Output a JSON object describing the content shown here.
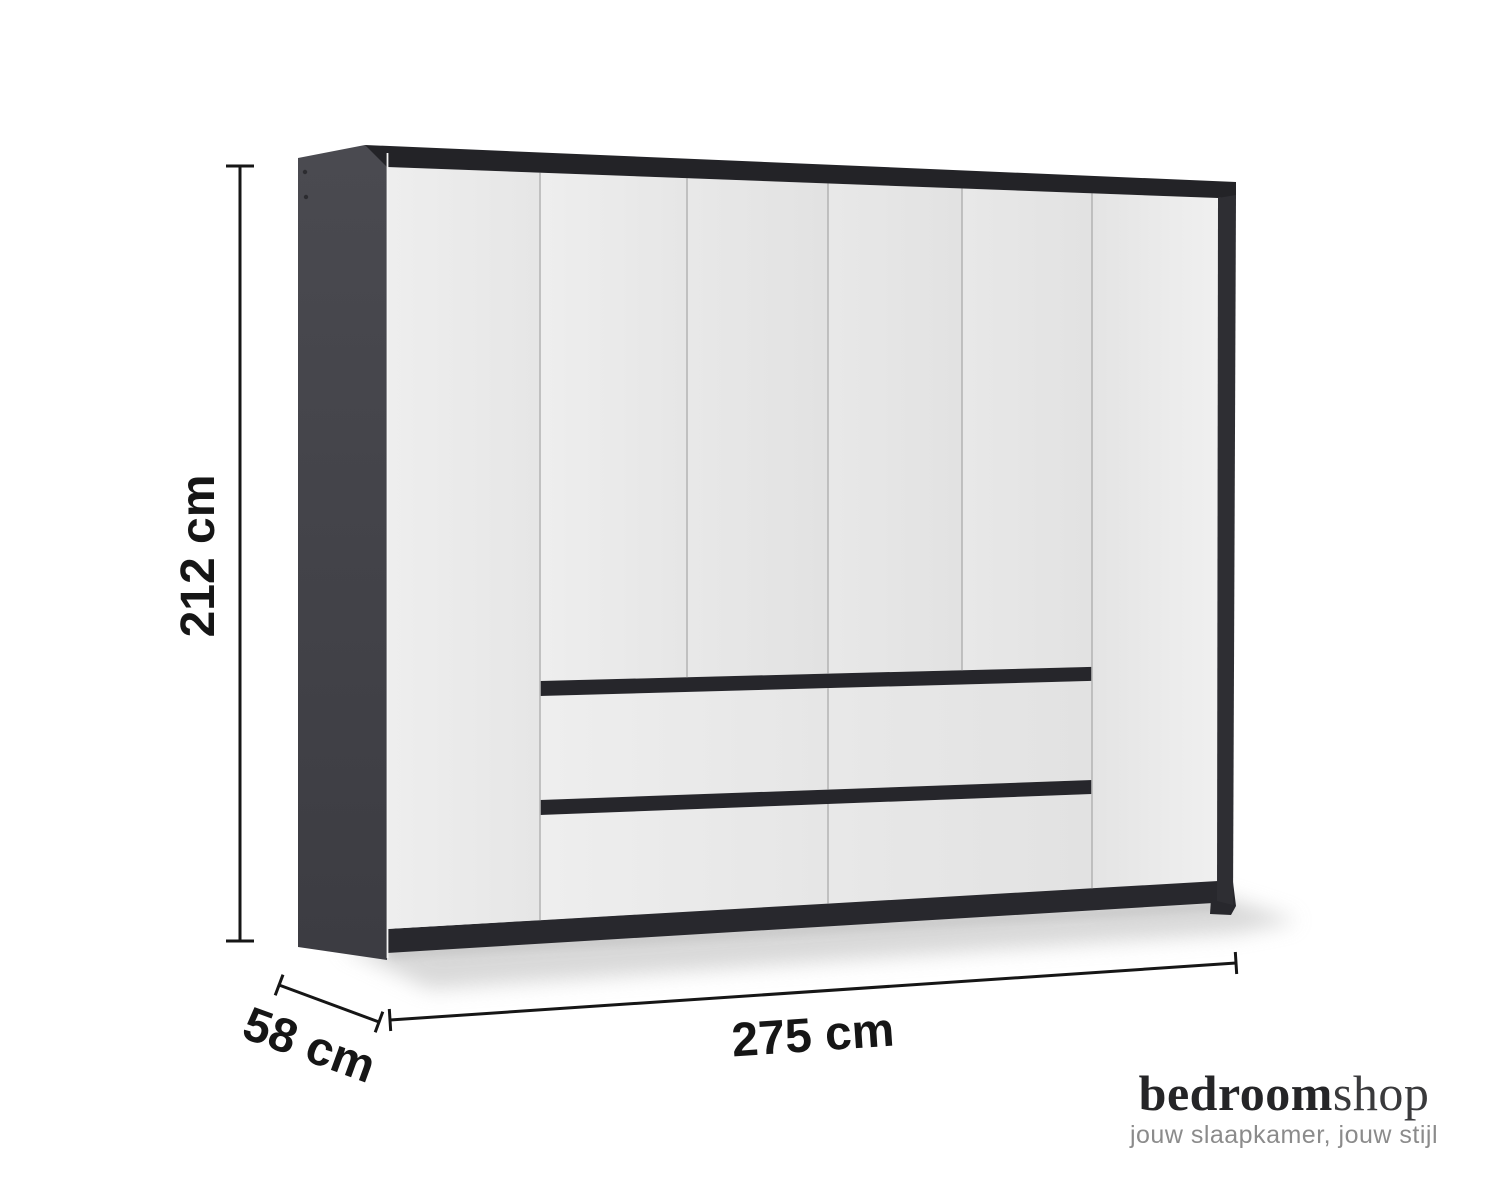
{
  "page": {
    "background": "#ffffff"
  },
  "dimensions": {
    "height": "212 cm",
    "depth": "58 cm",
    "width": "275 cm"
  },
  "wardrobe": {
    "door_count": 6,
    "drawer_count": 4,
    "drawer_handle_strips": 2
  },
  "logo": {
    "brand_bold": "bedroom",
    "brand_light": "shop",
    "tagline": "jouw slaapkamer, jouw stijl"
  },
  "colors": {
    "page_bg": "#ffffff",
    "carcass_dark": "#45454b",
    "top_frame": "#232327",
    "right_frame": "#2e2e33",
    "plinth": "#28282d",
    "handle_strip": "#26262b",
    "door_white": "#e9e9e9",
    "gap_line": "#b6b6b6",
    "dimension_ink": "#161616",
    "logo_dark": "#252527",
    "logo_light": "#3a3a3c",
    "tagline_gray": "#8b8b8b",
    "shadow": "#c9c9c9"
  }
}
